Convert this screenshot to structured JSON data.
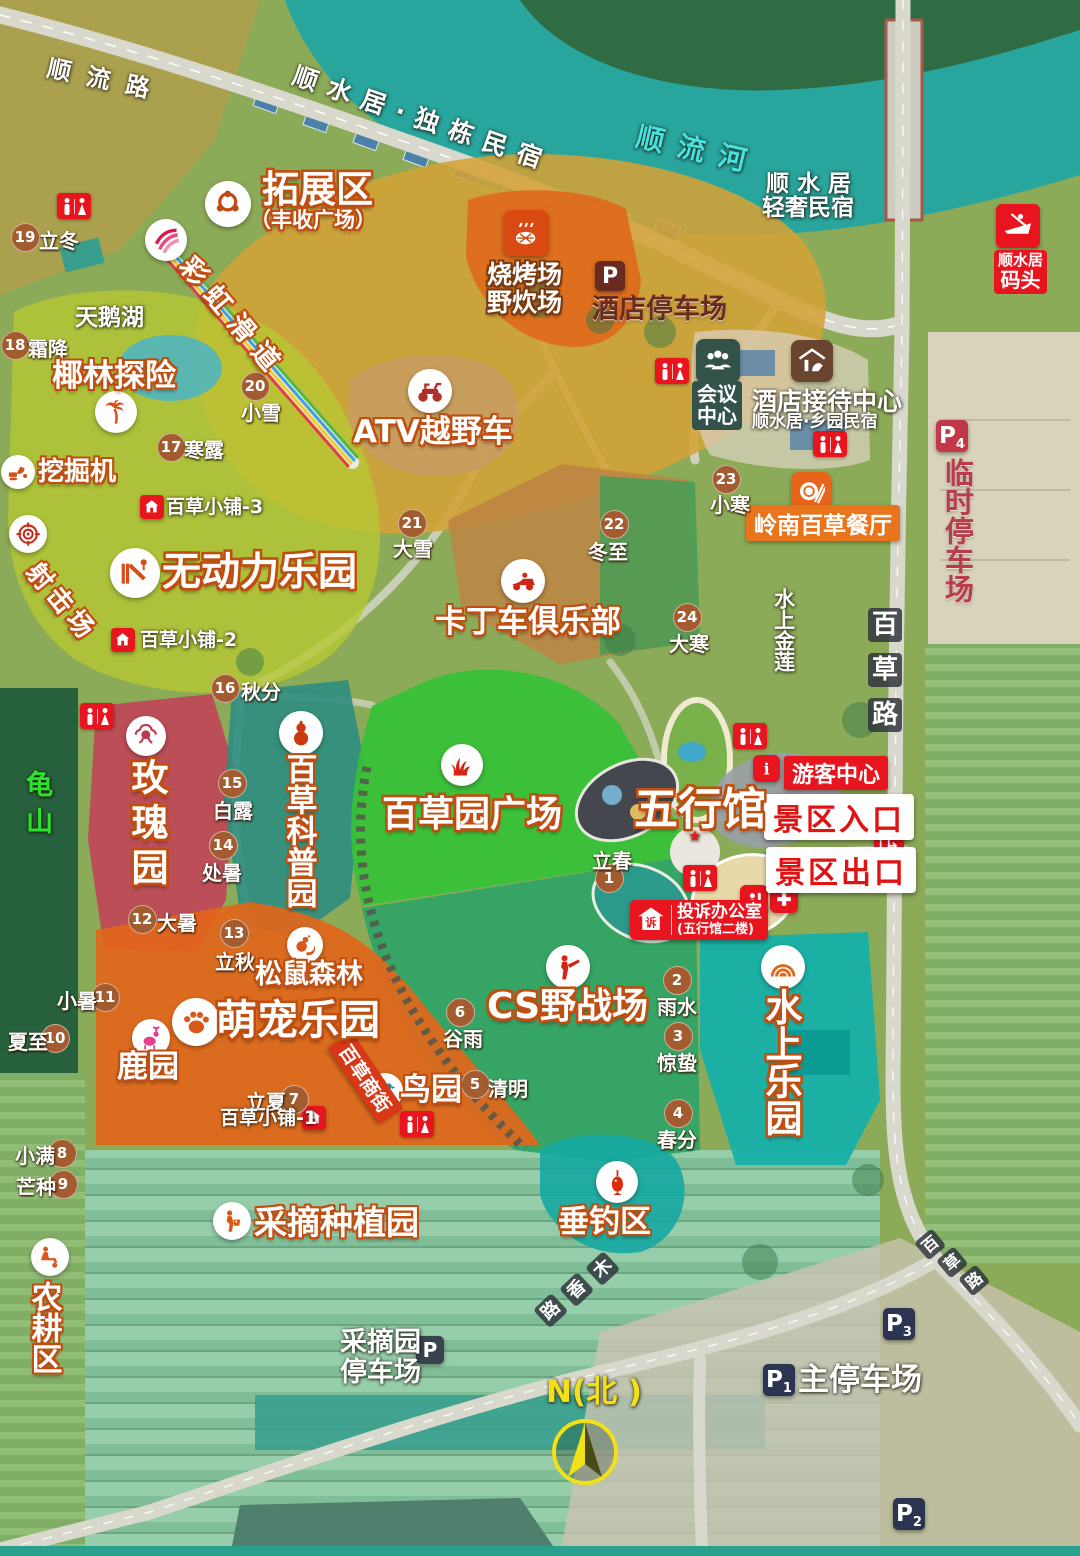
{
  "colors": {
    "zone_outline": "#c04e10",
    "river": "#28a59c",
    "term_circle": "#a25c30",
    "red_badge": "#e8141e",
    "meeting_badge": "#33524a",
    "hotel_parking": "#6b2a20",
    "temp_parking": "#c23848",
    "main_parking": "#2b3450",
    "compass_yellow": "#f2e018",
    "mountain_green": "#2be32b",
    "river_text": "#49e2df"
  },
  "labels": [
    {
      "n": "zone-tuozhanqu",
      "k": "o",
      "t": "拓展区",
      "x": 262,
      "y": 170,
      "s": 37
    },
    {
      "n": "zone-tuozhanqu-sub",
      "k": "o",
      "t": "（丰收广场）",
      "x": 250,
      "y": 209,
      "s": 21
    },
    {
      "n": "zone-wudongli-leyuan",
      "k": "o",
      "t": "无动力乐园",
      "x": 162,
      "y": 552,
      "s": 39
    },
    {
      "n": "zone-yelin-tanxian",
      "k": "o",
      "t": "椰林探险",
      "x": 52,
      "y": 360,
      "s": 31
    },
    {
      "n": "poi-wajueji",
      "k": "o",
      "t": "挖掘机",
      "x": 38,
      "y": 458,
      "s": 26
    },
    {
      "n": "zone-shejichang",
      "k": "o",
      "t": "射击场",
      "x": 42,
      "y": 558,
      "s": 26,
      "r": 50,
      "ls": 5
    },
    {
      "n": "zone-atv-yueyeche",
      "k": "o",
      "t": "ATV越野车",
      "x": 353,
      "y": 416,
      "s": 31
    },
    {
      "n": "zone-kadingche-julebu",
      "k": "o",
      "t": "卡丁车俱乐部",
      "x": 435,
      "y": 606,
      "s": 31
    },
    {
      "n": "zone-meigui-yuan",
      "k": "o",
      "t": "玫瑰园",
      "x": 126,
      "y": 758,
      "s": 37,
      "v": 1,
      "ls": 8
    },
    {
      "n": "zone-baicao-kepu-yuan",
      "k": "o",
      "t": "百草科普园",
      "x": 281,
      "y": 753,
      "s": 31,
      "v": 1
    },
    {
      "n": "zone-baicaoyuan-guangchang",
      "k": "o",
      "t": "百草园广场",
      "x": 382,
      "y": 796,
      "s": 36
    },
    {
      "n": "zone-cs-yezhanchang",
      "k": "o",
      "t": "CS野战场",
      "x": 487,
      "y": 988,
      "s": 36
    },
    {
      "n": "zone-wuxingguan",
      "k": "o",
      "t": "五行馆",
      "x": 634,
      "y": 786,
      "s": 44
    },
    {
      "n": "zone-mengchong-leyuan",
      "k": "o",
      "t": "萌宠乐园",
      "x": 216,
      "y": 998,
      "s": 41
    },
    {
      "n": "poi-luyuan",
      "k": "o",
      "t": "鹿园",
      "x": 117,
      "y": 1051,
      "s": 31
    },
    {
      "n": "poi-niaoyuan",
      "k": "o",
      "t": "鸟园",
      "x": 400,
      "y": 1074,
      "s": 31
    },
    {
      "n": "zone-songshu-senlin",
      "k": "o",
      "t": "松鼠森林",
      "x": 255,
      "y": 960,
      "s": 27
    },
    {
      "n": "zone-shuishang-leyuan",
      "k": "o",
      "t": "水上乐园",
      "x": 760,
      "y": 988,
      "s": 37,
      "v": 1
    },
    {
      "n": "zone-chuidiao-qu",
      "k": "o",
      "t": "垂钓区",
      "x": 558,
      "y": 1206,
      "s": 31
    },
    {
      "n": "zone-caizhai-zhongzhiyuan",
      "k": "o",
      "t": "采摘种植园",
      "x": 254,
      "y": 1205,
      "s": 33
    },
    {
      "n": "zone-nonggeng-qu",
      "k": "o",
      "t": "农耕区",
      "x": 26,
      "y": 1281,
      "s": 31,
      "v": 1
    },
    {
      "n": "poi-caihong-huadao",
      "k": "o",
      "t": "彩虹滑道",
      "x": 196,
      "y": 252,
      "s": 27,
      "r": 50,
      "ls": 10
    },
    {
      "n": "zone-shaokaochang",
      "k": "o",
      "t": "烧烤场",
      "x": 487,
      "y": 261,
      "s": 25,
      "oc": "#7a3a10"
    },
    {
      "n": "zone-yechuichang",
      "k": "o",
      "t": "野炊场",
      "x": 487,
      "y": 289,
      "s": 25,
      "oc": "#7a3a10"
    },
    {
      "n": "poi-tianehu",
      "k": "p",
      "t": "天鹅湖",
      "x": 75,
      "y": 306,
      "s": 23
    },
    {
      "n": "river-shunliuhe",
      "k": "p",
      "t": "顺流河",
      "x": 640,
      "y": 122,
      "s": 28,
      "c": "#49e2df",
      "ls": 14,
      "r": 13
    },
    {
      "n": "road-shunliulu",
      "k": "p",
      "t": "顺流路",
      "x": 50,
      "y": 56,
      "s": 24,
      "r": 12,
      "ls": 16
    },
    {
      "n": "poi-dudong-minsu",
      "k": "p",
      "t": "顺水居·独栋民宿",
      "x": 298,
      "y": 62,
      "s": 25,
      "r": 19,
      "ls": 11
    },
    {
      "n": "poi-qingshe-minsu-1",
      "k": "p",
      "t": "顺 水 居",
      "x": 766,
      "y": 172,
      "s": 23
    },
    {
      "n": "poi-qingshe-minsu-2",
      "k": "p",
      "t": "轻奢民宿",
      "x": 762,
      "y": 196,
      "s": 23
    },
    {
      "n": "poi-shuishang-jinlian",
      "k": "p",
      "t": "水上金莲",
      "x": 772,
      "y": 588,
      "s": 21,
      "v": 1
    },
    {
      "n": "poi-guishan",
      "k": "p",
      "t": "龟山",
      "x": 22,
      "y": 770,
      "s": 27,
      "v": 1,
      "c": "#2be32b",
      "ls": 10
    },
    {
      "n": "poi-hotel-reception",
      "k": "p",
      "t": "酒店接待中心",
      "x": 752,
      "y": 388,
      "s": 25
    },
    {
      "n": "poi-hotel-reception-sub",
      "k": "p",
      "t": "顺水居·乡园民宿",
      "x": 752,
      "y": 413,
      "s": 17
    },
    {
      "n": "poi-hotel-parking-label",
      "k": "p",
      "t": "酒店停车场",
      "x": 592,
      "y": 295,
      "s": 27,
      "c": "#6b2a20",
      "sh": "#f2e6cf"
    },
    {
      "n": "poi-temp-parking-label",
      "k": "p",
      "t": "临时停车场",
      "x": 941,
      "y": 458,
      "s": 29,
      "v": 1,
      "c": "#b83c4c",
      "sh": "#f2e6cf"
    },
    {
      "n": "poi-main-parking-label",
      "k": "p",
      "t": "主停车场",
      "x": 798,
      "y": 1364,
      "s": 31
    },
    {
      "n": "poi-picking-parking-1",
      "k": "p",
      "t": "采摘园",
      "x": 340,
      "y": 1328,
      "s": 27
    },
    {
      "n": "poi-picking-parking-2",
      "k": "p",
      "t": "停车场",
      "x": 340,
      "y": 1358,
      "s": 27
    },
    {
      "n": "compass-label",
      "k": "p",
      "t": "N(北 )",
      "x": 546,
      "y": 1376,
      "s": 31,
      "c": "#f2e018"
    },
    {
      "n": "wuxing-star",
      "k": "p",
      "t": "★",
      "x": 688,
      "y": 828,
      "s": 15,
      "c": "#e81818"
    }
  ],
  "road_char_labels": [
    {
      "n": "road-baicaolu-east",
      "box": 34,
      "s": 26,
      "r": 0,
      "chars": [
        [
          "百",
          868,
          608
        ],
        [
          "草",
          868,
          653
        ],
        [
          "路",
          868,
          698
        ]
      ]
    },
    {
      "n": "road-muxianglu",
      "box": 25,
      "s": 18,
      "r": -43,
      "chars": [
        [
          "木",
          585,
          1268
        ],
        [
          "香",
          559,
          1289
        ],
        [
          "路",
          533,
          1310
        ]
      ]
    },
    {
      "n": "road-baicaolu-south",
      "box": 23,
      "s": 16,
      "r": -40,
      "chars": [
        [
          "百",
          914,
          1243
        ],
        [
          "草",
          936,
          1261
        ],
        [
          "路",
          958,
          1279
        ]
      ]
    }
  ],
  "solar_terms": [
    {
      "n": 1,
      "t": "立春",
      "cx": 608,
      "cy": 877,
      "lx": 592,
      "ly": 845
    },
    {
      "n": 2,
      "t": "雨水",
      "cx": 676,
      "cy": 979,
      "lx": 657,
      "ly": 991
    },
    {
      "n": 3,
      "t": "惊蛰",
      "cx": 677,
      "cy": 1035,
      "lx": 657,
      "ly": 1047
    },
    {
      "n": 4,
      "t": "春分",
      "cx": 677,
      "cy": 1112,
      "lx": 657,
      "ly": 1124
    },
    {
      "n": 5,
      "t": "清明",
      "cx": 474,
      "cy": 1083,
      "lx": 488,
      "ly": 1073
    },
    {
      "n": 6,
      "t": "谷雨",
      "cx": 459,
      "cy": 1011,
      "lx": 443,
      "ly": 1023
    },
    {
      "n": 7,
      "t": "立夏",
      "cx": 293,
      "cy": 1098,
      "lx": 246,
      "ly": 1086
    },
    {
      "n": 8,
      "t": "小满",
      "cx": 61,
      "cy": 1152,
      "lx": 15,
      "ly": 1140
    },
    {
      "n": 9,
      "t": "芒种",
      "cx": 62,
      "cy": 1183,
      "lx": 16,
      "ly": 1171
    },
    {
      "n": 10,
      "t": "夏至",
      "cx": 54,
      "cy": 1037,
      "lx": 8,
      "ly": 1026
    },
    {
      "n": 11,
      "t": "小暑",
      "cx": 104,
      "cy": 996,
      "lx": 57,
      "ly": 985
    },
    {
      "n": 12,
      "t": "大暑",
      "cx": 141,
      "cy": 918,
      "lx": 157,
      "ly": 907
    },
    {
      "n": 13,
      "t": "立秋",
      "cx": 233,
      "cy": 932,
      "lx": 215,
      "ly": 946
    },
    {
      "n": 14,
      "t": "处暑",
      "cx": 222,
      "cy": 844,
      "lx": 202,
      "ly": 857
    },
    {
      "n": 15,
      "t": "白露",
      "cx": 231,
      "cy": 782,
      "lx": 213,
      "ly": 795
    },
    {
      "n": 16,
      "t": "秋分",
      "cx": 224,
      "cy": 687,
      "lx": 241,
      "ly": 676
    },
    {
      "n": 17,
      "t": "寒露",
      "cx": 170,
      "cy": 446,
      "lx": 184,
      "ly": 434
    },
    {
      "n": 18,
      "t": "霜降",
      "cx": 14,
      "cy": 344,
      "lx": 28,
      "ly": 333
    },
    {
      "n": 19,
      "t": "立冬",
      "cx": 24,
      "cy": 236,
      "lx": 39,
      "ly": 225
    },
    {
      "n": 20,
      "t": "小雪",
      "cx": 254,
      "cy": 385,
      "lx": 241,
      "ly": 397
    },
    {
      "n": 21,
      "t": "大雪",
      "cx": 411,
      "cy": 522,
      "lx": 393,
      "ly": 533
    },
    {
      "n": 22,
      "t": "冬至",
      "cx": 613,
      "cy": 523,
      "lx": 588,
      "ly": 536
    },
    {
      "n": 23,
      "t": "小寒",
      "cx": 725,
      "cy": 478,
      "lx": 710,
      "ly": 489
    },
    {
      "n": 24,
      "t": "大寒",
      "cx": 686,
      "cy": 616,
      "lx": 669,
      "ly": 628
    }
  ],
  "circle_icons": [
    {
      "k": "ring",
      "n": "expansion-icon",
      "x": 228,
      "y": 204,
      "d": 46,
      "c": "#c24a12"
    },
    {
      "k": "rainbow",
      "n": "rainbow-slide-icon",
      "x": 166,
      "y": 240,
      "d": 42,
      "c": "#e04878"
    },
    {
      "k": "palm",
      "n": "palm-adventure-icon",
      "x": 116,
      "y": 412,
      "d": 42,
      "c": "#d84e1a"
    },
    {
      "k": "digger",
      "n": "excavator-icon",
      "x": 18,
      "y": 472,
      "d": 34,
      "c": "#d84e1a"
    },
    {
      "k": "target",
      "n": "shooting-range-icon",
      "x": 28,
      "y": 534,
      "d": 38,
      "c": "#cc2814"
    },
    {
      "k": "slide",
      "n": "slide-park-icon",
      "x": 135,
      "y": 573,
      "d": 50,
      "c": "#d84e1a"
    },
    {
      "k": "atv",
      "n": "atv-icon",
      "x": 430,
      "y": 391,
      "d": 44,
      "c": "#b03028"
    },
    {
      "k": "kart",
      "n": "gokart-icon",
      "x": 523,
      "y": 581,
      "d": 44,
      "c": "#cc2814"
    },
    {
      "k": "rose",
      "n": "rose-garden-icon",
      "x": 146,
      "y": 736,
      "d": 40,
      "c": "#bb3a50"
    },
    {
      "k": "gourd",
      "n": "herb-garden-icon",
      "x": 301,
      "y": 733,
      "d": 44,
      "c": "#cc3810"
    },
    {
      "k": "grass",
      "n": "plaza-grass-icon",
      "x": 462,
      "y": 765,
      "d": 42,
      "c": "#d42414"
    },
    {
      "k": "soldier",
      "n": "cs-battle-icon",
      "x": 568,
      "y": 967,
      "d": 44,
      "c": "#d42414"
    },
    {
      "k": "paw",
      "n": "pet-park-icon",
      "x": 196,
      "y": 1022,
      "d": 48,
      "c": "#d8581a"
    },
    {
      "k": "deer",
      "n": "deer-garden-icon",
      "x": 151,
      "y": 1038,
      "d": 38,
      "c": "#e43e8e"
    },
    {
      "k": "bird",
      "n": "bird-garden-icon",
      "x": 385,
      "y": 1091,
      "d": 36,
      "c": "#20929e"
    },
    {
      "k": "squirrel",
      "n": "squirrel-forest-icon",
      "x": 305,
      "y": 945,
      "d": 36,
      "c": "#d8581a"
    },
    {
      "k": "wave",
      "n": "water-park-icon",
      "x": 783,
      "y": 967,
      "d": 44,
      "c": "#e06818"
    },
    {
      "k": "fish",
      "n": "fishing-icon",
      "x": 617,
      "y": 1182,
      "d": 42,
      "c": "#de2a0e"
    },
    {
      "k": "farmer",
      "n": "farming-zone-icon",
      "x": 50,
      "y": 1257,
      "d": 38,
      "c": "#d8581a"
    },
    {
      "k": "picker",
      "n": "picking-garden-icon",
      "x": 232,
      "y": 1221,
      "d": 38,
      "c": "#d8581a"
    }
  ],
  "restrooms": [
    [
      57,
      193
    ],
    [
      655,
      358
    ],
    [
      813,
      431
    ],
    [
      80,
      703
    ],
    [
      733,
      723
    ],
    [
      683,
      865
    ],
    [
      400,
      1111
    ]
  ],
  "parking_badges": [
    {
      "n": "parking-hotel",
      "p": "P",
      "sub": "",
      "x": 595,
      "y": 261,
      "b": 30,
      "c": "#6b2a20"
    },
    {
      "n": "parking-p4",
      "p": "P",
      "sub": "4",
      "x": 936,
      "y": 420,
      "b": 32,
      "c": "#c23848"
    },
    {
      "n": "parking-p1",
      "p": "P",
      "sub": "1",
      "x": 763,
      "y": 1364,
      "b": 32,
      "c": "#2b3450"
    },
    {
      "n": "parking-p3",
      "p": "P",
      "sub": "3",
      "x": 883,
      "y": 1308,
      "b": 32,
      "c": "#2b3450"
    },
    {
      "n": "parking-p2",
      "p": "P",
      "sub": "2",
      "x": 893,
      "y": 1498,
      "b": 32,
      "c": "#2b3450"
    },
    {
      "n": "parking-picking",
      "p": "P",
      "sub": "",
      "x": 416,
      "y": 1336,
      "b": 28,
      "c": "#39434e"
    }
  ],
  "shops": [
    {
      "t": "百草小铺-3",
      "x": 166,
      "y": 497,
      "ix": 140,
      "iy": 495
    },
    {
      "t": "百草小铺-2",
      "x": 140,
      "y": 630,
      "ix": 111,
      "iy": 628
    },
    {
      "t": "百草小铺-1",
      "x": 220,
      "y": 1108,
      "ix": 302,
      "iy": 1106
    }
  ],
  "facilities": {
    "visitor_center": "游客中心",
    "entrance": "景区入口",
    "exit": "景区出口",
    "pier_line1": "顺水居",
    "pier_line2": "码头",
    "meeting_line1": "会议",
    "meeting_line2": "中心",
    "restaurant": "岭南百草餐厅",
    "complaint_line1": "投诉办公室",
    "complaint_line2": "(五行馆二楼)",
    "shop_street": "百草商街"
  }
}
